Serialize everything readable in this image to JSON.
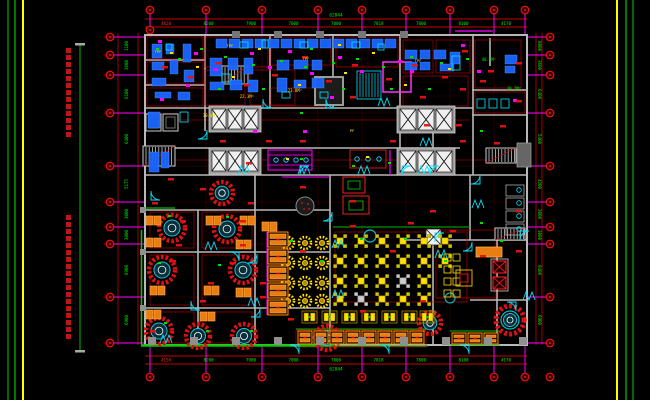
{
  "sheet": {
    "background": "#000000",
    "border_outer_color": "#00aa00",
    "border_inner_color": "#ffff00",
    "note_columns": 2
  },
  "dimensions": {
    "top": {
      "segments": [
        "4820",
        "8200",
        "7900",
        "7000",
        "7000",
        "7818",
        "7800",
        "8100",
        "4170"
      ],
      "total": "62844"
    },
    "bottom": {
      "segments": [
        "4150",
        "8200",
        "7900",
        "7000",
        "7000",
        "7818",
        "7800",
        "8100",
        "4170"
      ],
      "total": "62844"
    },
    "left": {
      "segments": [
        "1100",
        "3600",
        "6100",
        "6400",
        "5175",
        "3000",
        "3000",
        "6900",
        "6900"
      ]
    },
    "right": {
      "segments": [
        "8000",
        "3600",
        "6400",
        "5400",
        "4200",
        "3000",
        "3000",
        "9400",
        "6900"
      ]
    }
  },
  "labels": {
    "areas": [
      "48.5M²",
      "30.2M²",
      "22.3M²",
      "10.0M²",
      "23.8M²"
    ],
    "equipment": [
      "TPF",
      "TPF",
      "TPF",
      "TPF",
      "PF"
    ]
  },
  "colors": {
    "dim_line_red": "#cc0000",
    "dim_text_green": "#00ee00",
    "dim_text_red": "#ff2222",
    "grid_stem_magenta": "#ff00ff",
    "wall_gray": "#b8b8b8",
    "equipment_blue": "#1b66ff",
    "fixture_cyan": "#00e5ff",
    "table_red": "#dd1111",
    "table_yellow": "#ffe000",
    "booth_orange": "#ff8800",
    "accent_green": "#00cc00",
    "note_red": "#cc1515"
  },
  "symbols": {
    "elevator_banks": 4,
    "round_tables": 11,
    "square_tables": 22,
    "flower_tables": 12,
    "grid_bubbles_top": 9,
    "grid_bubbles_bottom": 10,
    "grid_bubbles_left": 10,
    "grid_bubbles_right": 10
  }
}
